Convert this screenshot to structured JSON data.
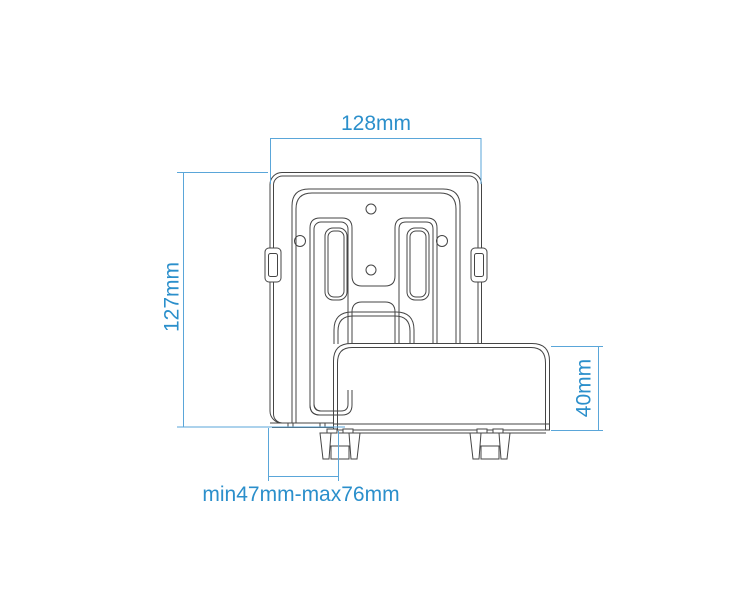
{
  "diagram": {
    "kind": "technical dimension drawing of a wall mount bracket",
    "dimensions": {
      "top_width": "128mm",
      "left_height": "127mm",
      "front_height": "40mm",
      "bottom_range": "min47mm-max76mm"
    },
    "colors": {
      "dimension_text": "#2b8fcb",
      "dimension_line": "#5aa6d9",
      "drawing_line": "#454545",
      "background": "#ffffff"
    }
  }
}
